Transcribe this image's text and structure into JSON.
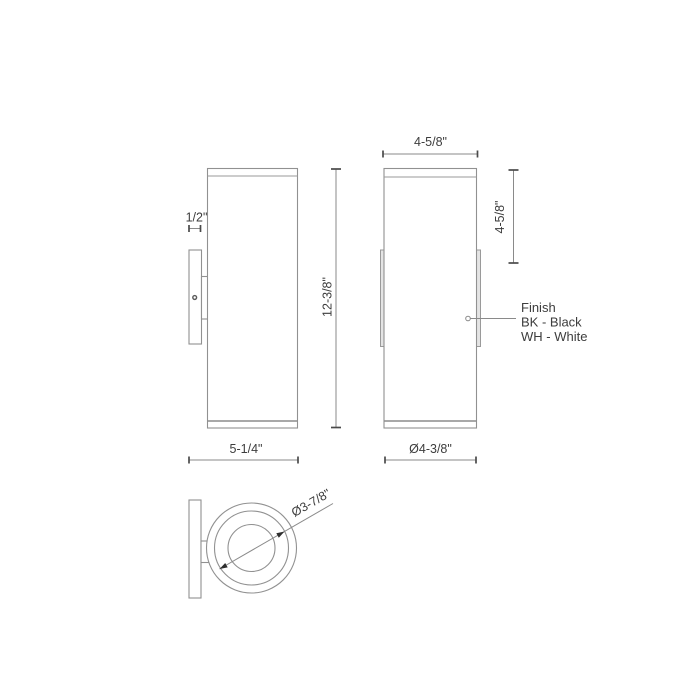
{
  "dimensions": {
    "bracket_depth": "1/2\"",
    "overall_height": "12-3/8\"",
    "overall_depth": "5-1/4\"",
    "body_width": "4-5/8\"",
    "backplate_height": "4-5/8\"",
    "body_diameter": "Ø4-3/8\"",
    "inner_diameter": "Ø3-7/8\""
  },
  "finish_note": {
    "title": "Finish",
    "options": [
      "BK - Black",
      "WH - White"
    ]
  },
  "colors": {
    "background": "#ffffff",
    "object_line": "#919191",
    "dimension_line": "#8a8a8a",
    "tick": "#4a4a4a",
    "text": "#3d3d3d",
    "tab_fill": "#e4e4e4"
  }
}
